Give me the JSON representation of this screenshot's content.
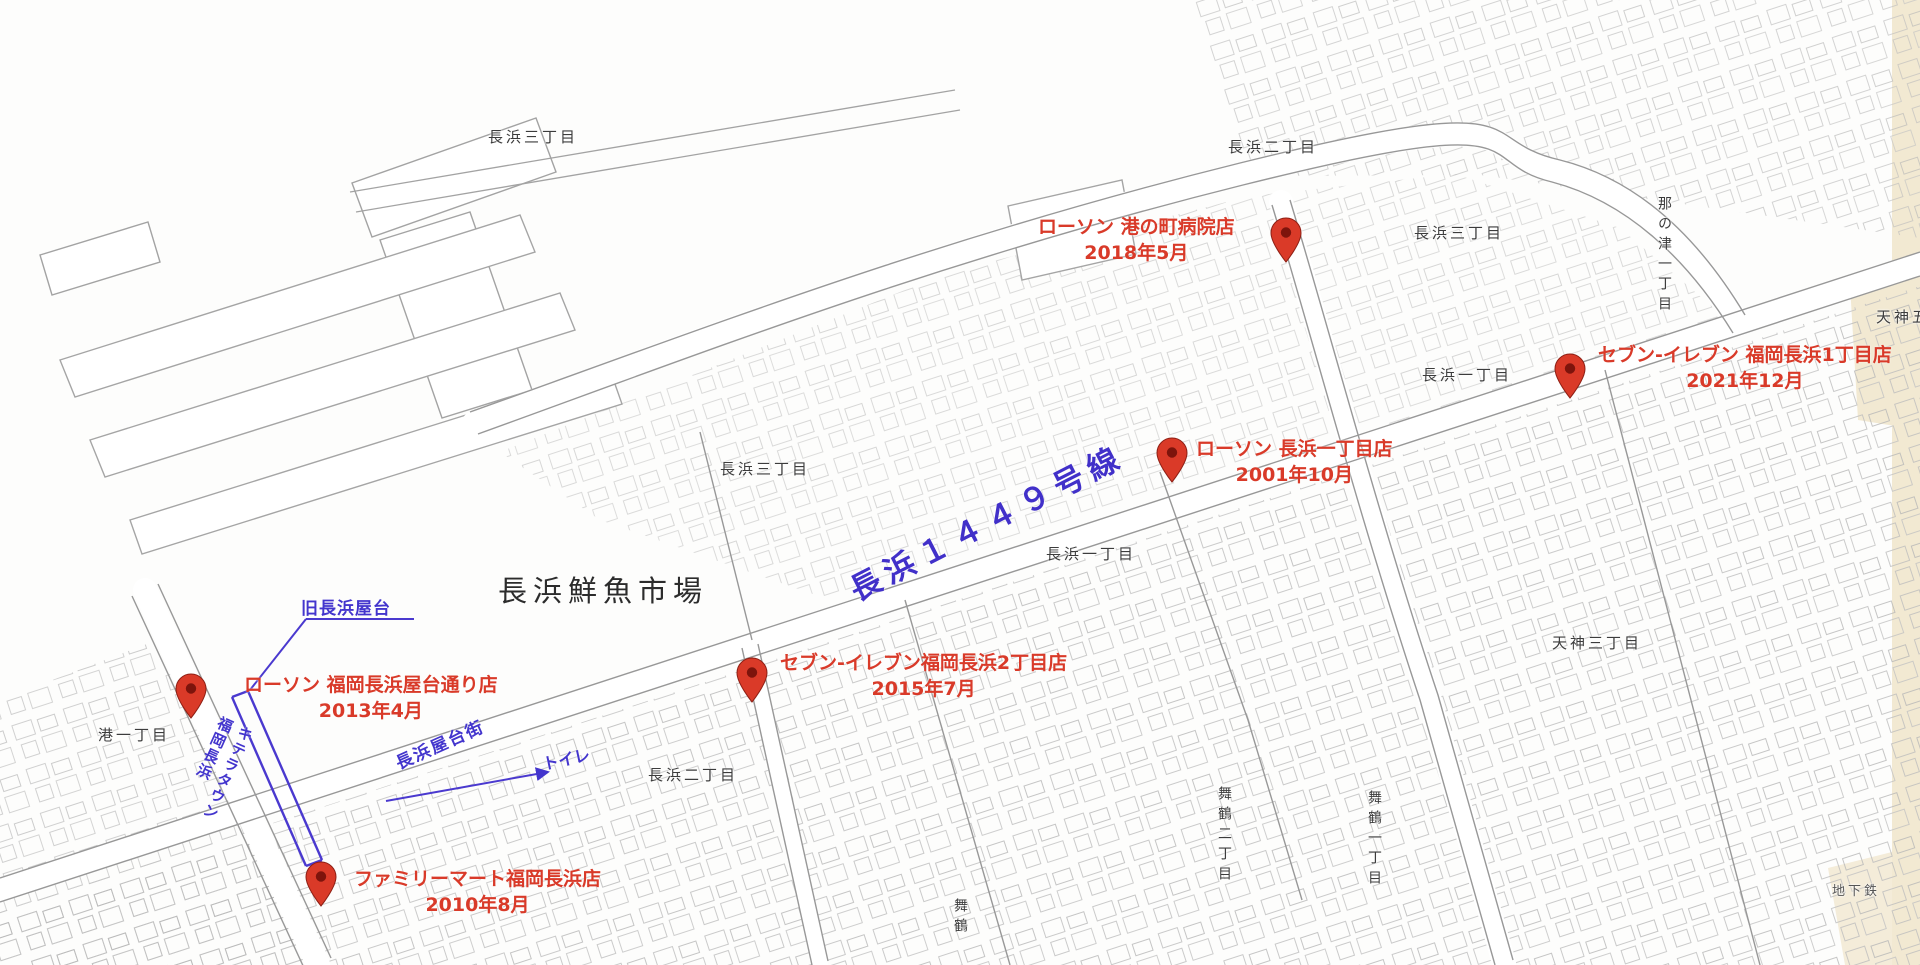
{
  "map": {
    "region": "福岡市中央区長浜周辺",
    "colors": {
      "annotation_red": "#d93a29",
      "annotation_blue": "#4335cd",
      "map_line_gray": "#989898",
      "district_label_gray": "#3c3c3c",
      "zone_beige": "#f2e9d2",
      "background": "#fdfdfc"
    }
  },
  "landmarks": {
    "fish_market": "長浜鮮魚市場",
    "road_name": "長浜１４４９号線",
    "old_yatai": "旧長浜屋台",
    "yatai_street": "長浜屋台街",
    "toilet": "トイレ",
    "kitera_town_line1": "キテラタウン",
    "kitera_town_line2": "福岡長浜"
  },
  "districts": [
    {
      "label": "長浜三丁目"
    },
    {
      "label": "長浜二丁目"
    },
    {
      "label": "長浜三丁目"
    },
    {
      "label": "長浜一丁目"
    },
    {
      "label": "長浜三丁目"
    },
    {
      "label": "長浜一丁目"
    },
    {
      "label": "長浜二丁目"
    },
    {
      "label": "港一丁目"
    },
    {
      "label": "天神三丁目"
    },
    {
      "label": "那の津一丁目"
    },
    {
      "label": "天神五"
    },
    {
      "label": "舞鶴二丁目"
    },
    {
      "label": "舞鶴一丁目"
    },
    {
      "label": "舞鶴"
    },
    {
      "label": "地下鉄"
    }
  ],
  "stores": [
    {
      "name": "ローソン 港の町病院店",
      "opened": "2018年5月"
    },
    {
      "name": "セブン-イレブン 福岡長浜1丁目店",
      "opened": "2021年12月"
    },
    {
      "name": "ローソン 長浜一丁目店",
      "opened": "2001年10月"
    },
    {
      "name": "セブン-イレブン福岡長浜2丁目店",
      "opened": "2015年7月"
    },
    {
      "name": "ローソン 福岡長浜屋台通り店",
      "opened": "2013年4月"
    },
    {
      "name": "ファミリーマート福岡長浜店",
      "opened": "2010年8月"
    }
  ]
}
